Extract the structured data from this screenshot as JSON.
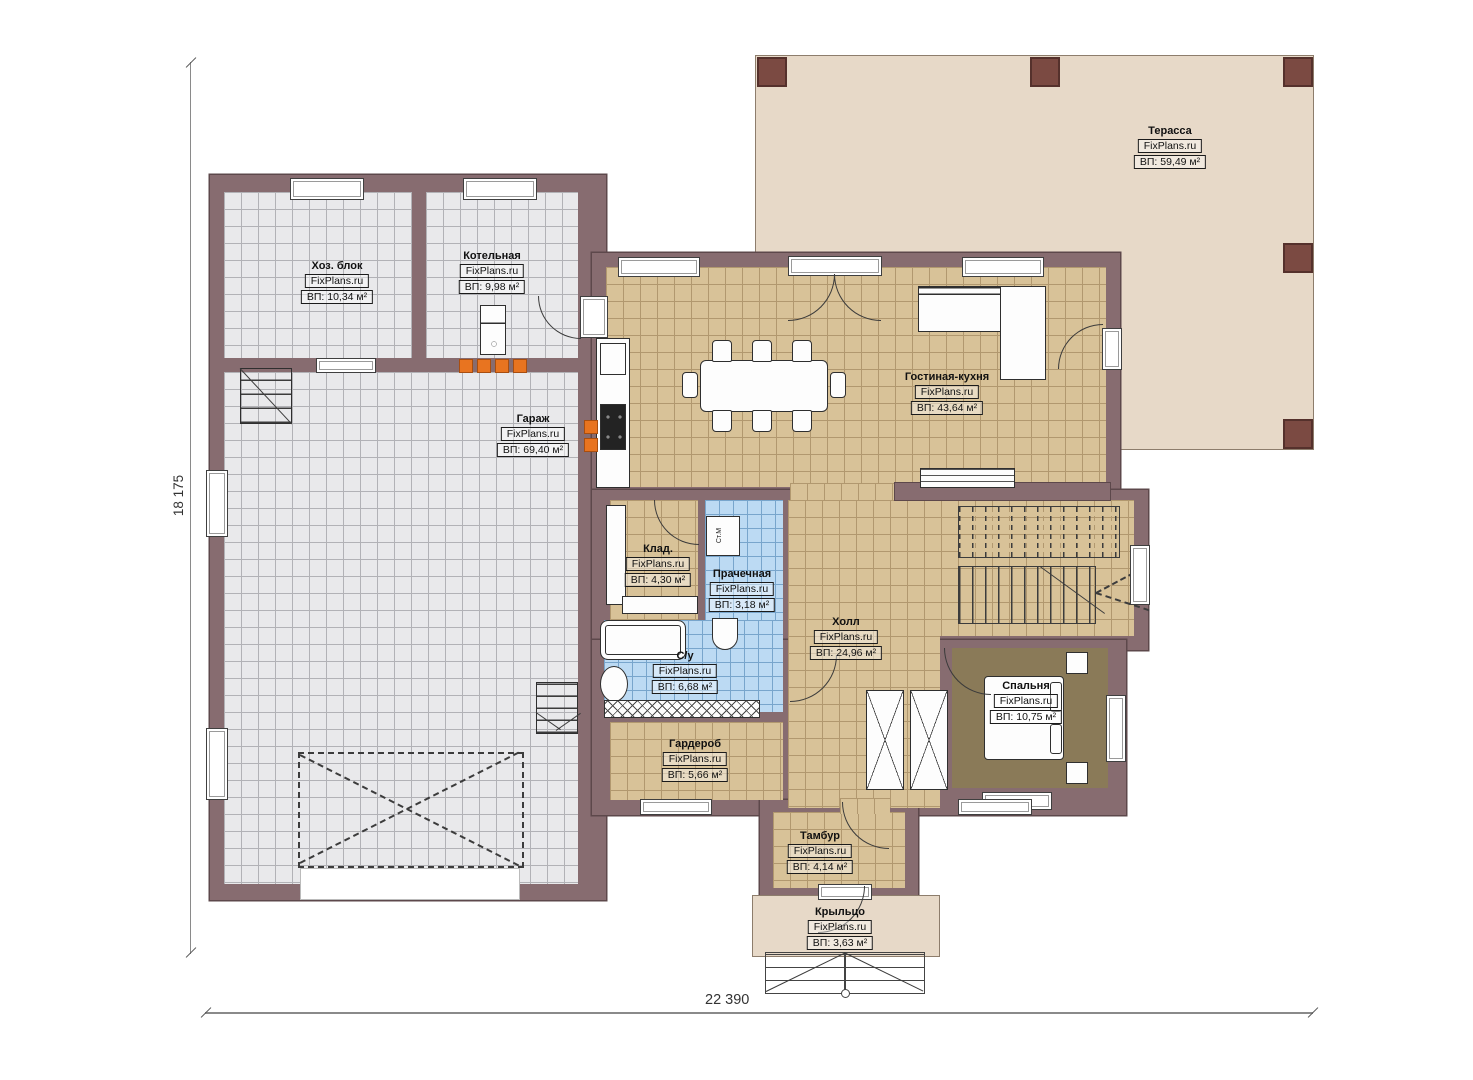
{
  "meta": {
    "brand": "FixPlans.ru",
    "type": "floor-plan"
  },
  "dimensions": {
    "height_label": "18 175",
    "width_label": "22 390"
  },
  "rooms": [
    {
      "id": "terrace",
      "name": "Терасса",
      "area": "ВП: 59,49 м²"
    },
    {
      "id": "hozblok",
      "name": "Хоз. блок",
      "area": "ВП: 10,34 м²"
    },
    {
      "id": "boiler",
      "name": "Котельная",
      "area": "ВП: 9,98 м²"
    },
    {
      "id": "garage",
      "name": "Гараж",
      "area": "ВП: 69,40 м²"
    },
    {
      "id": "living",
      "name": "Гостиная-кухня",
      "area": "ВП: 43,64 м²"
    },
    {
      "id": "storage",
      "name": "Клад.",
      "area": "ВП: 4,30 м²"
    },
    {
      "id": "laundry",
      "name": "Прачечная",
      "area": "ВП: 3,18 м²"
    },
    {
      "id": "hall",
      "name": "Холл",
      "area": "ВП: 24,96 м²"
    },
    {
      "id": "bath",
      "name": "С/у",
      "area": "ВП: 6,68 м²"
    },
    {
      "id": "wardrobe",
      "name": "Гардероб",
      "area": "ВП: 5,66 м²"
    },
    {
      "id": "bedroom",
      "name": "Спальня",
      "area": "ВП: 10,75 м²"
    },
    {
      "id": "tambur",
      "name": "Тамбур",
      "area": "ВП: 4,14 м²"
    },
    {
      "id": "porch",
      "name": "Крыльцо",
      "area": "ВП: 3,63 м²"
    }
  ],
  "appliances": {
    "washer_label": "Ст.М"
  },
  "colors": {
    "wall": "#876c70",
    "wall_outline": "#5d484b",
    "terrace": "#e7d9c8",
    "floor_gray": "#e9e9eb",
    "floor_tan": "#d8c298",
    "floor_blue": "#bcdaf3",
    "floor_bedroom": "#8a7a58",
    "radiator_orange": "#e87420",
    "post_brown": "#7b4a42"
  }
}
